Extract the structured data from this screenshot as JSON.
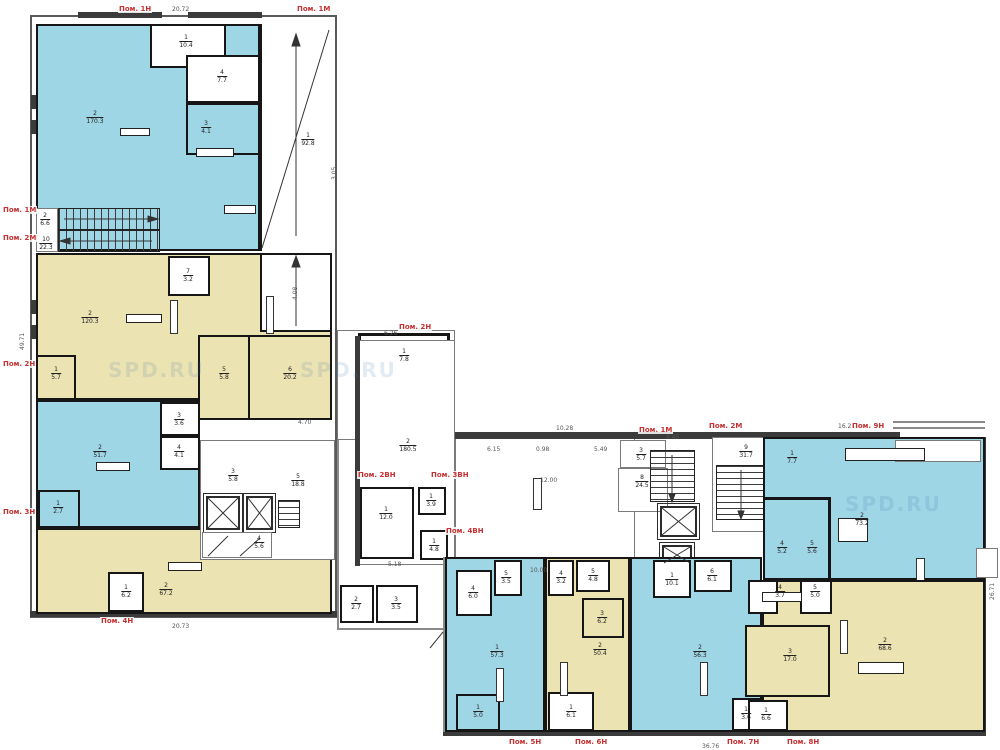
{
  "drawing": {
    "type": "floor-plan",
    "watermark_text": "SPD.RU"
  },
  "palette": {
    "blue": "#9fd6e6",
    "yellow": "#ece3b3",
    "label_red": "#c53030",
    "wall_dark": "#3b3b3b",
    "partition": "#151515"
  },
  "premises": [
    {
      "text": "Пом. 1Н",
      "x": 118,
      "y": 5
    },
    {
      "text": "Пом. 1М",
      "x": 296,
      "y": 5
    },
    {
      "text": "Пом. 1М",
      "x": 2,
      "y": 206
    },
    {
      "text": "Пом. 2М",
      "x": 2,
      "y": 234
    },
    {
      "text": "Пом. 2Н",
      "x": 2,
      "y": 360
    },
    {
      "text": "Пом. 3Н",
      "x": 2,
      "y": 508
    },
    {
      "text": "Пом. 4Н",
      "x": 100,
      "y": 617
    },
    {
      "text": "Пом. 2Н",
      "x": 398,
      "y": 323
    },
    {
      "text": "Пом. 2ВН",
      "x": 357,
      "y": 471
    },
    {
      "text": "Пом. 3ВН",
      "x": 430,
      "y": 471
    },
    {
      "text": "Пом. 4ВН",
      "x": 445,
      "y": 527
    },
    {
      "text": "Пом. 1М",
      "x": 638,
      "y": 426
    },
    {
      "text": "Пом. 2М",
      "x": 708,
      "y": 422
    },
    {
      "text": "Пом. 9Н",
      "x": 851,
      "y": 422
    },
    {
      "text": "Пом. 5Н",
      "x": 508,
      "y": 738
    },
    {
      "text": "Пом. 6Н",
      "x": 574,
      "y": 738
    },
    {
      "text": "Пом. 7Н",
      "x": 726,
      "y": 738
    },
    {
      "text": "Пом. 8Н",
      "x": 786,
      "y": 738
    }
  ],
  "rooms": [
    {
      "num": "2",
      "area": "170.3",
      "x": 95,
      "y": 118
    },
    {
      "num": "1",
      "area": "10.4",
      "x": 186,
      "y": 42
    },
    {
      "num": "4",
      "area": "7.7",
      "x": 222,
      "y": 77
    },
    {
      "num": "3",
      "area": "4.1",
      "x": 206,
      "y": 128
    },
    {
      "num": "1",
      "area": "92.8",
      "x": 308,
      "y": 140
    },
    {
      "num": "2",
      "area": "6.6",
      "x": 45,
      "y": 220
    },
    {
      "num": "10",
      "area": "22.3",
      "x": 46,
      "y": 244
    },
    {
      "num": "7",
      "area": "3.2",
      "x": 188,
      "y": 276
    },
    {
      "num": "2",
      "area": "120.3",
      "x": 90,
      "y": 318
    },
    {
      "num": "5",
      "area": "5.8",
      "x": 224,
      "y": 374
    },
    {
      "num": "6",
      "area": "20.2",
      "x": 290,
      "y": 374
    },
    {
      "num": "1",
      "area": "5.7",
      "x": 56,
      "y": 374
    },
    {
      "num": "2",
      "area": "51.7",
      "x": 100,
      "y": 452
    },
    {
      "num": "3",
      "area": "3.6",
      "x": 179,
      "y": 420
    },
    {
      "num": "4",
      "area": "4.1",
      "x": 179,
      "y": 452
    },
    {
      "num": "1",
      "area": "2.7",
      "x": 58,
      "y": 508
    },
    {
      "num": "2",
      "area": "67.2",
      "x": 166,
      "y": 590
    },
    {
      "num": "1",
      "area": "6.2",
      "x": 126,
      "y": 592
    },
    {
      "num": "4",
      "area": "5.6",
      "x": 259,
      "y": 543
    },
    {
      "num": "3",
      "area": "5.8",
      "x": 233,
      "y": 476
    },
    {
      "num": "5",
      "area": "18.8",
      "x": 298,
      "y": 481
    },
    {
      "num": "1",
      "area": "7.8",
      "x": 404,
      "y": 356
    },
    {
      "num": "2",
      "area": "180.5",
      "x": 408,
      "y": 446
    },
    {
      "num": "1",
      "area": "12.0",
      "x": 386,
      "y": 514
    },
    {
      "num": "1",
      "area": "3.9",
      "x": 431,
      "y": 501
    },
    {
      "num": "1",
      "area": "4.8",
      "x": 434,
      "y": 546
    },
    {
      "num": "2",
      "area": "2.7",
      "x": 356,
      "y": 604
    },
    {
      "num": "3",
      "area": "3.5",
      "x": 396,
      "y": 604
    },
    {
      "num": "3",
      "area": "5.7",
      "x": 641,
      "y": 455
    },
    {
      "num": "8",
      "area": "24.5",
      "x": 642,
      "y": 482
    },
    {
      "num": "9",
      "area": "31.7",
      "x": 746,
      "y": 452
    },
    {
      "num": "1",
      "area": "7.7",
      "x": 792,
      "y": 458
    },
    {
      "num": "2",
      "area": "73.2",
      "x": 862,
      "y": 520
    },
    {
      "num": "4",
      "area": "5.2",
      "x": 782,
      "y": 548
    },
    {
      "num": "5",
      "area": "5.6",
      "x": 812,
      "y": 548
    },
    {
      "num": "1",
      "area": "57.3",
      "x": 497,
      "y": 652
    },
    {
      "num": "4",
      "area": "6.0",
      "x": 473,
      "y": 593
    },
    {
      "num": "5",
      "area": "3.5",
      "x": 506,
      "y": 578
    },
    {
      "num": "1",
      "area": "5.0",
      "x": 478,
      "y": 712
    },
    {
      "num": "2",
      "area": "50.4",
      "x": 600,
      "y": 650
    },
    {
      "num": "4",
      "area": "3.2",
      "x": 561,
      "y": 578
    },
    {
      "num": "5",
      "area": "4.8",
      "x": 593,
      "y": 576
    },
    {
      "num": "3",
      "area": "6.2",
      "x": 602,
      "y": 618
    },
    {
      "num": "1",
      "area": "6.1",
      "x": 571,
      "y": 712
    },
    {
      "num": "2",
      "area": "56.3",
      "x": 700,
      "y": 652
    },
    {
      "num": "1",
      "area": "10.1",
      "x": 672,
      "y": 580
    },
    {
      "num": "6",
      "area": "6.1",
      "x": 712,
      "y": 576
    },
    {
      "num": "1",
      "area": "3.6",
      "x": 746,
      "y": 714
    },
    {
      "num": "2",
      "area": "68.6",
      "x": 885,
      "y": 645
    },
    {
      "num": "3",
      "area": "17.0",
      "x": 790,
      "y": 656
    },
    {
      "num": "4",
      "area": "3.7",
      "x": 780,
      "y": 592
    },
    {
      "num": "5",
      "area": "5.0",
      "x": 815,
      "y": 592
    },
    {
      "num": "1",
      "area": "6.6",
      "x": 766,
      "y": 715
    }
  ],
  "dims": [
    {
      "text": "20.72",
      "x": 172,
      "y": 7,
      "rot": false
    },
    {
      "text": "49.71",
      "x": 20,
      "y": 350,
      "rot": true
    },
    {
      "text": "20.73",
      "x": 172,
      "y": 624,
      "rot": false
    },
    {
      "text": "6.26",
      "x": 384,
      "y": 331,
      "rot": false
    },
    {
      "text": "10.28",
      "x": 556,
      "y": 426,
      "rot": false
    },
    {
      "text": "6.15",
      "x": 487,
      "y": 447,
      "rot": false
    },
    {
      "text": "0.98",
      "x": 536,
      "y": 447,
      "rot": false
    },
    {
      "text": "5.49",
      "x": 594,
      "y": 447,
      "rot": false
    },
    {
      "text": "12.00",
      "x": 540,
      "y": 478,
      "rot": false
    },
    {
      "text": "10.00",
      "x": 530,
      "y": 568,
      "rot": false
    },
    {
      "text": "9.45",
      "x": 666,
      "y": 435,
      "rot": false
    },
    {
      "text": "16.24",
      "x": 838,
      "y": 424,
      "rot": false
    },
    {
      "text": "26.71",
      "x": 990,
      "y": 600,
      "rot": true
    },
    {
      "text": "36.76",
      "x": 702,
      "y": 744,
      "rot": false
    },
    {
      "text": "5.18",
      "x": 388,
      "y": 562,
      "rot": false
    },
    {
      "text": "4.70",
      "x": 298,
      "y": 420,
      "rot": false
    },
    {
      "text": "4.08",
      "x": 293,
      "y": 300,
      "rot": true
    },
    {
      "text": "3.05",
      "x": 332,
      "y": 180,
      "rot": true
    }
  ],
  "watermarks": [
    {
      "x": 108,
      "y": 358
    },
    {
      "x": 300,
      "y": 358
    },
    {
      "x": 845,
      "y": 492
    }
  ]
}
